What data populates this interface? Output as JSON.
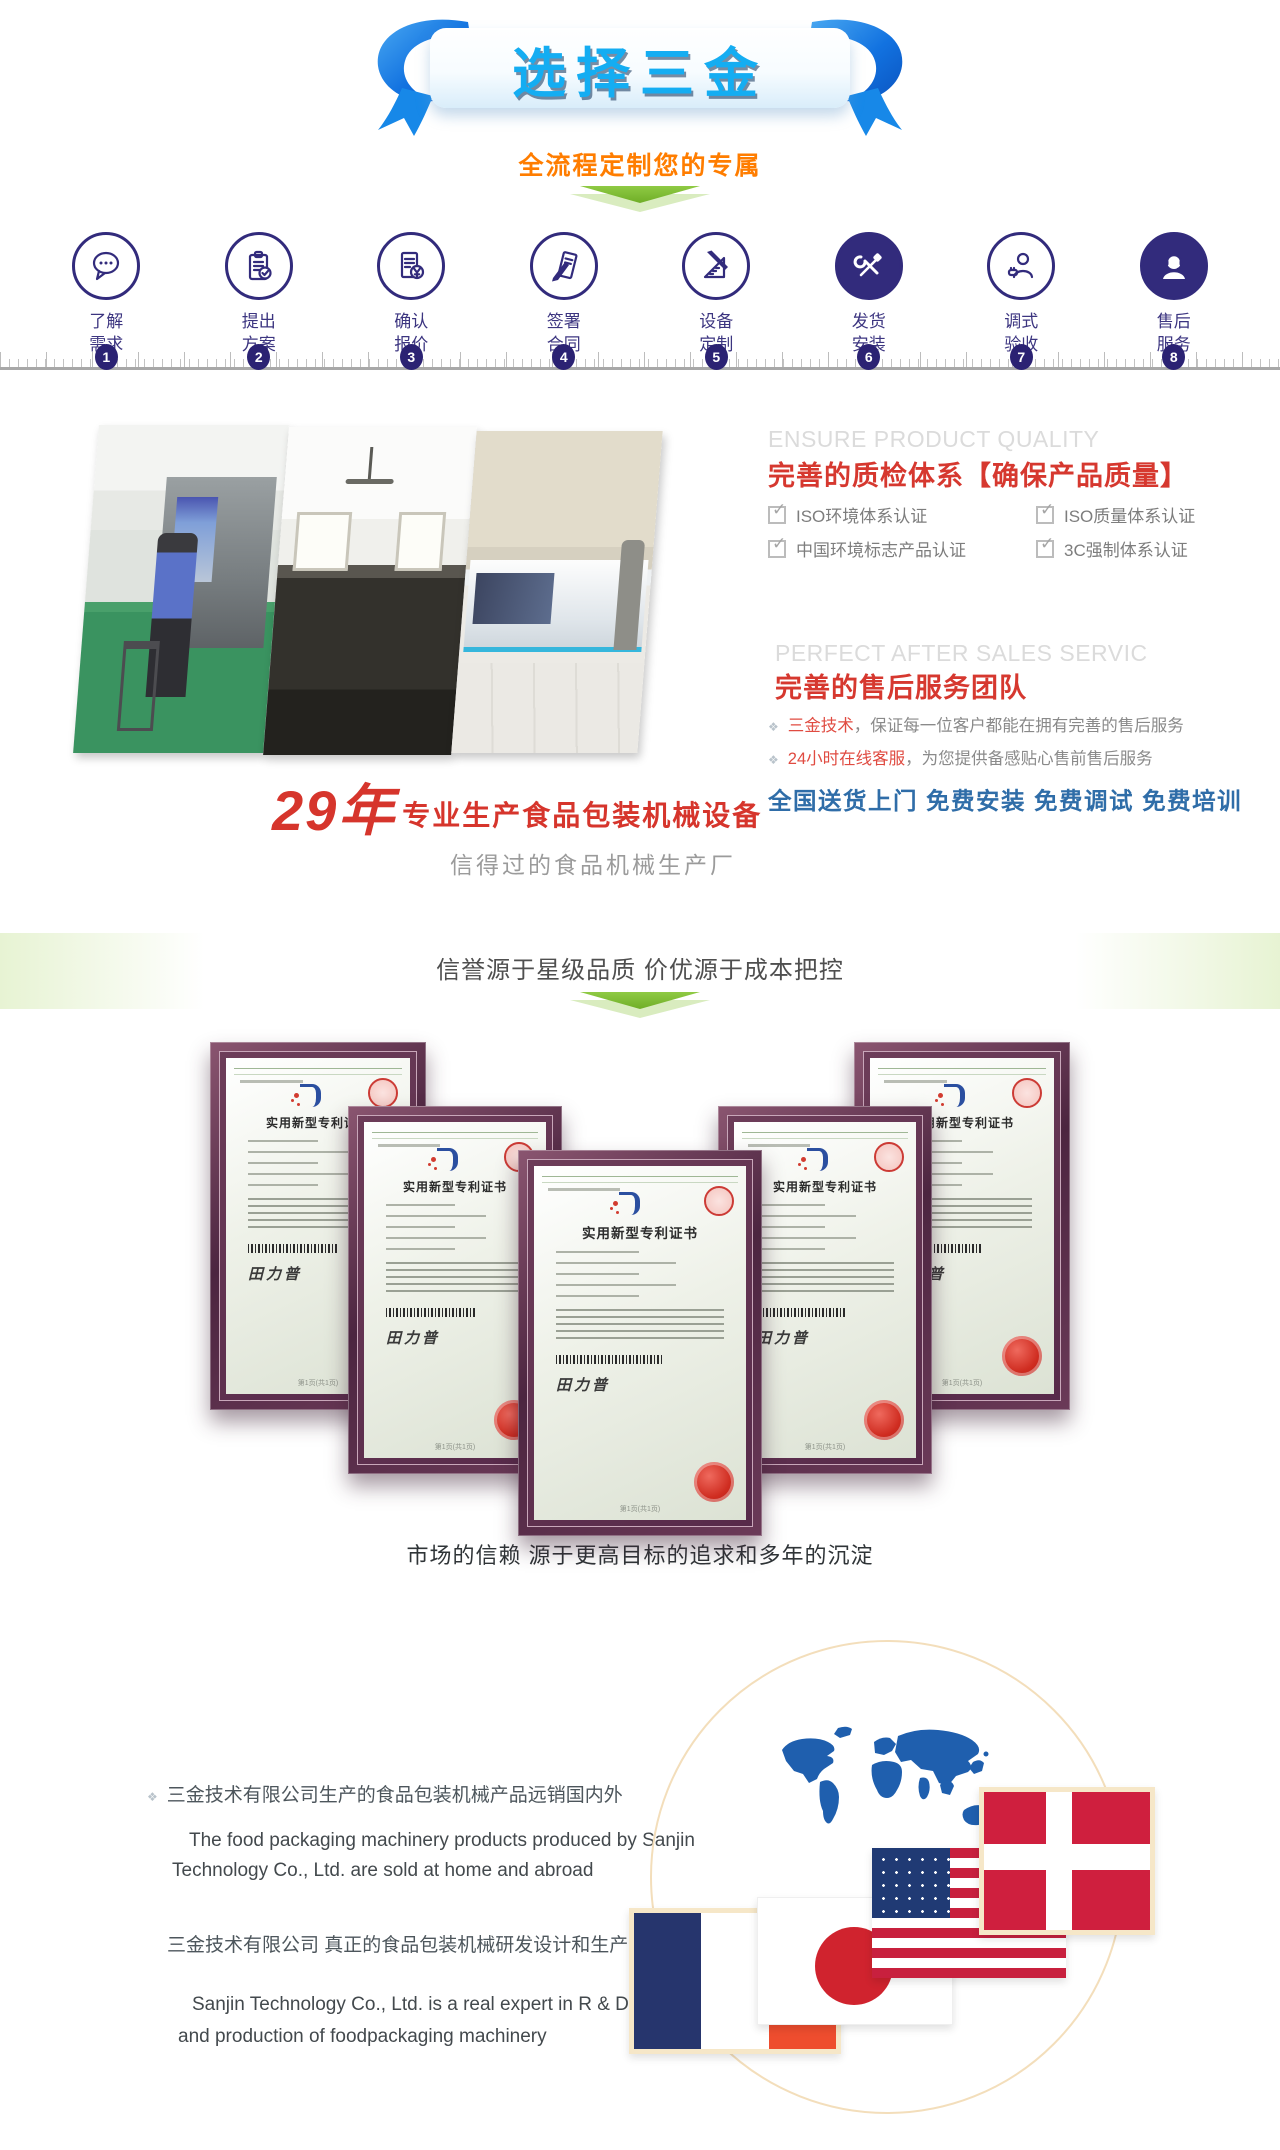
{
  "banner": {
    "title": "选择三金",
    "subtitle": "全流程定制您的专属"
  },
  "steps": [
    {
      "num": "1",
      "line1": "了解",
      "line2": "需求",
      "icon": "chat-icon"
    },
    {
      "num": "2",
      "line1": "提出",
      "line2": "方案",
      "icon": "clipboard-check-icon"
    },
    {
      "num": "3",
      "line1": "确认",
      "line2": "报价",
      "icon": "quote-yen-icon"
    },
    {
      "num": "4",
      "line1": "签署",
      "line2": "合同",
      "icon": "sign-pen-icon"
    },
    {
      "num": "5",
      "line1": "设备",
      "line2": "定制",
      "icon": "ruler-pencil-icon"
    },
    {
      "num": "6",
      "line1": "发货",
      "line2": "安装",
      "icon": "tools-icon"
    },
    {
      "num": "7",
      "line1": "调式",
      "line2": "验收",
      "icon": "inspector-icon"
    },
    {
      "num": "8",
      "line1": "售后",
      "line2": "服务",
      "icon": "headset-icon"
    }
  ],
  "quality": {
    "en_title": "ENSURE PRODUCT QUALITY",
    "cn_title": "完善的质检体系【确保产品质量】",
    "certs": [
      "ISO环境体系认证",
      "ISO质量体系认证",
      "中国环境标志产品认证",
      "3C强制体系认证"
    ]
  },
  "service": {
    "en_title": "PERFECT AFTER SALES SERVIC",
    "cn_title": "完善的售后服务团队",
    "items": [
      {
        "lead": "三金技术",
        "rest": "，保证每一位客户都能在拥有完善的售后服务"
      },
      {
        "lead": "24小时在线客服",
        "rest": "，为您提供备感贴心售前售后服务"
      }
    ],
    "highlight": "全国送货上门  免费安装  免费调试  免费培训"
  },
  "experience": {
    "years": "29年",
    "title": "专业生产食品包装机械设备",
    "subtitle": "信得过的食品机械生产厂"
  },
  "certificates": {
    "heading": "信誉源于星级品质 价优源于成本把控",
    "cert_title": "实用新型专利证书",
    "signature": "田力普",
    "footer": "第1页(共1页)"
  },
  "market": {
    "heading": "市场的信赖 源于更高目标的追求和多年的沉淀",
    "blocks": [
      {
        "cn": "三金技术有限公司生产的食品包装机械产品远销国内外",
        "en1": "The food packaging machinery products produced by Sanjin",
        "en2": "Technology Co., Ltd. are sold at home and abroad"
      },
      {
        "cn": "三金技术有限公司  真正的食品包装机械研发设计和生产制造专家",
        "en1": "Sanjin Technology Co., Ltd. is a real expert in R & D, design",
        "en2": "and production of foodpackaging machinery"
      }
    ],
    "flags": [
      "denmark-flag",
      "usa-flag",
      "japan-flag",
      "france-flag"
    ]
  },
  "colors": {
    "title_cyan": "#14adf2",
    "ribbon_blue": "#1272e0",
    "subtitle_orange": "#ff7d00",
    "step_indigo": "#322b7c",
    "accent_red": "#d6382f",
    "service_blue": "#2f6da8",
    "arrow_green": "#6fae27",
    "frame_maroon": "#5a2f47",
    "map_blue": "#1f5fae",
    "circle_tan": "#f3debb"
  }
}
